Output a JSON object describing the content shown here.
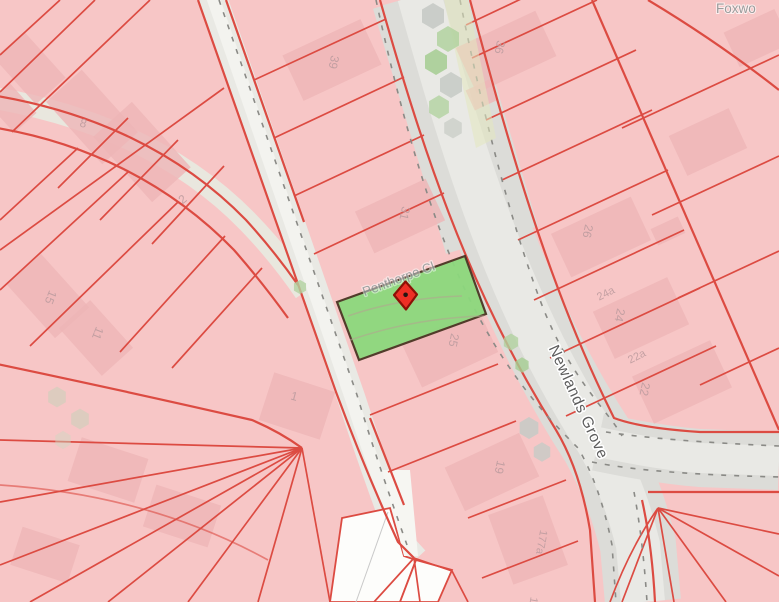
{
  "map": {
    "type": "parcel-map",
    "street_labels": [
      {
        "name": "Penthorpe Cl"
      },
      {
        "name": "Newlands Grove"
      },
      {
        "name": "Foxwo"
      }
    ],
    "house_numbers": [
      "39",
      "31",
      "25",
      "19",
      "36",
      "26",
      "24a",
      "24",
      "22a",
      "22",
      "177a",
      "175",
      "1",
      "2",
      "8",
      "15",
      "11"
    ],
    "selected_parcel": {
      "fill": "#8cd87d",
      "border": "#4a3523"
    },
    "marker": {
      "fill": "#ee2f25",
      "border": "#8c1006",
      "dot": "#241512"
    },
    "colors": {
      "parcel_fill": "#f7c6c6",
      "parcel_line": "#dc4b42",
      "building_fill": "#eeb5b7",
      "road_fill": "#dcdcd8",
      "road_inner": "#e9e9e5",
      "label_gray": "#9b9b9b",
      "house_number_gray": "#bf9da0"
    }
  }
}
